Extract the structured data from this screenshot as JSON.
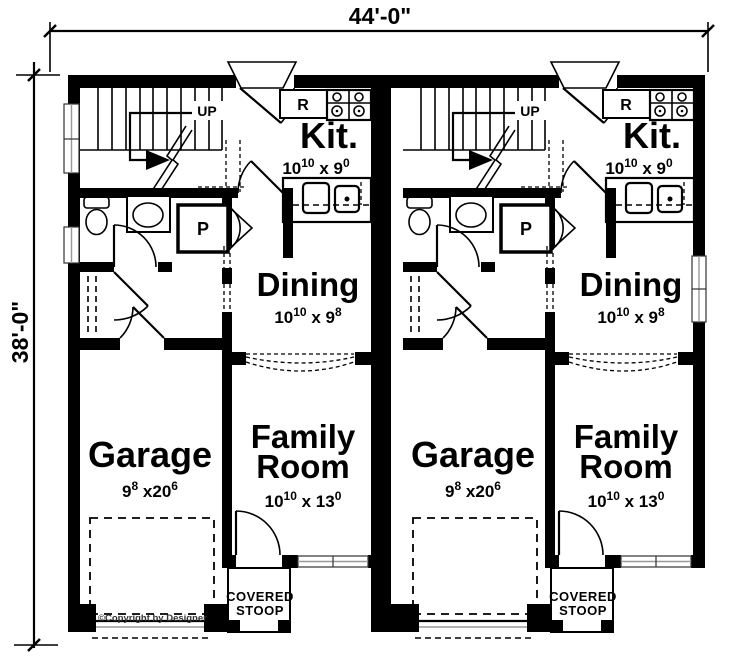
{
  "plan": {
    "type": "duplex-first-floor-plan",
    "overall_dimensions": {
      "width_label": "44'-0\"",
      "height_label": "38'-0\""
    },
    "labels": {
      "up": "UP",
      "fridge": "R",
      "pantry": "P"
    },
    "rooms": {
      "kitchen": {
        "name": "Kit.",
        "dim_a": "10",
        "dim_a_sup": "10",
        "dim_b": " x 9",
        "dim_b_sup": "0"
      },
      "dining": {
        "name": "Dining",
        "dim_a": "10",
        "dim_a_sup": "10",
        "dim_b": " x 9",
        "dim_b_sup": "8"
      },
      "garage": {
        "name": "Garage",
        "dim_a": "9",
        "dim_a_sup": "8",
        "dim_b": " x20",
        "dim_b_sup": "6"
      },
      "family": {
        "name_line1": "Family",
        "name_line2": "Room",
        "dim_a": "10",
        "dim_a_sup": "10",
        "dim_b": " x 13",
        "dim_b_sup": "0"
      },
      "stoop": {
        "line1": "COVERED",
        "line2": "STOOP"
      }
    },
    "copyright": "©Copyright by Designer",
    "units": {
      "left": "unit-left",
      "right": "unit-right"
    },
    "colors": {
      "wall": "#000000",
      "window_line": "#999999",
      "background": "#ffffff"
    }
  }
}
